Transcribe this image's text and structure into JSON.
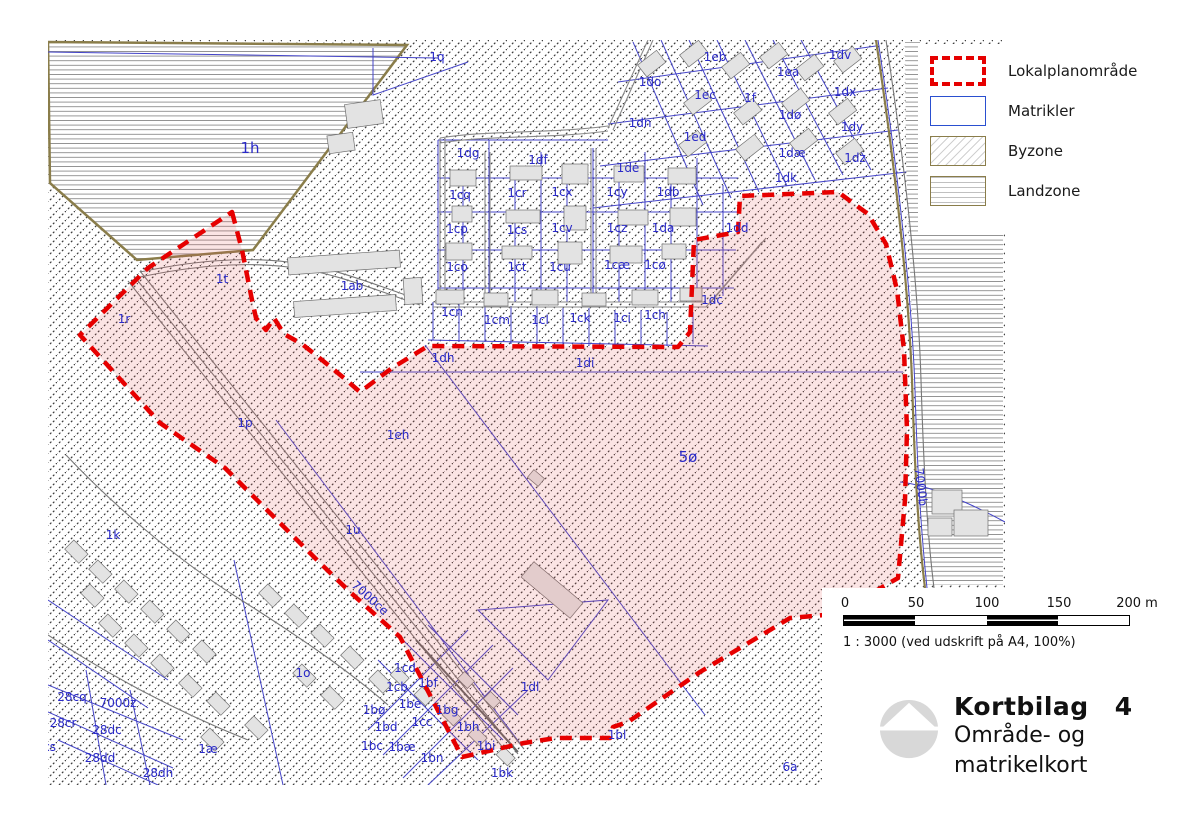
{
  "legend": {
    "items": [
      {
        "key": "lokalplan",
        "label": "Lokalplanområde"
      },
      {
        "key": "matrikler",
        "label": "Matrikler"
      },
      {
        "key": "byzone",
        "label": "Byzone"
      },
      {
        "key": "landzone",
        "label": "Landzone"
      }
    ]
  },
  "scalebar": {
    "ticks": [
      "0",
      "50",
      "100",
      "150",
      "200 m"
    ],
    "caption": "1 : 3000 (ved udskrift på A4, 100%)"
  },
  "title_block": {
    "title": "Kortbilag",
    "number": "4",
    "subtitle_line1": "Område- og",
    "subtitle_line2": "matrikelkort"
  },
  "colors": {
    "lokalplan_boundary": "#e60000",
    "lokalplan_fill": "rgba(228,90,90,0.16)",
    "parcel_line": "#4444c8",
    "label_text": "#2a2ac8",
    "road_olive": "#8a7d4a",
    "landzone_line": "#8f8f8f",
    "byzone_line": "#3c3c3c",
    "building_fill": "#e3e3e3"
  },
  "map": {
    "region_labels": [
      {
        "text": "1h",
        "x": 202,
        "y": 108,
        "size": 15
      },
      {
        "text": "1q",
        "x": 389,
        "y": 17
      },
      {
        "text": "1dg",
        "x": 420,
        "y": 113
      },
      {
        "text": "1df",
        "x": 490,
        "y": 120
      },
      {
        "text": "1de",
        "x": 580,
        "y": 128
      },
      {
        "text": "1cq",
        "x": 412,
        "y": 155
      },
      {
        "text": "1cr",
        "x": 469,
        "y": 153
      },
      {
        "text": "1cx",
        "x": 514,
        "y": 152
      },
      {
        "text": "1cy",
        "x": 569,
        "y": 152
      },
      {
        "text": "1db",
        "x": 620,
        "y": 152
      },
      {
        "text": "1cp",
        "x": 409,
        "y": 189
      },
      {
        "text": "1cs",
        "x": 469,
        "y": 190
      },
      {
        "text": "1cv",
        "x": 514,
        "y": 188
      },
      {
        "text": "1cz",
        "x": 569,
        "y": 188
      },
      {
        "text": "1da",
        "x": 615,
        "y": 188
      },
      {
        "text": "1co",
        "x": 409,
        "y": 227
      },
      {
        "text": "1ct",
        "x": 469,
        "y": 227
      },
      {
        "text": "1cu",
        "x": 512,
        "y": 227
      },
      {
        "text": "1cæ",
        "x": 569,
        "y": 225
      },
      {
        "text": "1cø",
        "x": 607,
        "y": 225
      },
      {
        "text": "1cn",
        "x": 404,
        "y": 272
      },
      {
        "text": "1cm",
        "x": 449,
        "y": 280
      },
      {
        "text": "1cl",
        "x": 492,
        "y": 280
      },
      {
        "text": "1ck",
        "x": 532,
        "y": 278
      },
      {
        "text": "1ci",
        "x": 574,
        "y": 278
      },
      {
        "text": "1ch",
        "x": 607,
        "y": 275
      },
      {
        "text": "1dd",
        "x": 689,
        "y": 188
      },
      {
        "text": "1dc",
        "x": 664,
        "y": 260
      },
      {
        "text": "1eb",
        "x": 667,
        "y": 17
      },
      {
        "text": "1dv",
        "x": 792,
        "y": 15
      },
      {
        "text": "1do",
        "x": 602,
        "y": 42
      },
      {
        "text": "1ea",
        "x": 740,
        "y": 32
      },
      {
        "text": "1ec",
        "x": 657,
        "y": 55
      },
      {
        "text": "1f",
        "x": 702,
        "y": 58
      },
      {
        "text": "1dx",
        "x": 797,
        "y": 52
      },
      {
        "text": "1dn",
        "x": 592,
        "y": 83
      },
      {
        "text": "1dø",
        "x": 742,
        "y": 75
      },
      {
        "text": "1dy",
        "x": 804,
        "y": 87
      },
      {
        "text": "1ed",
        "x": 647,
        "y": 97
      },
      {
        "text": "1dæ",
        "x": 744,
        "y": 113
      },
      {
        "text": "1dz",
        "x": 807,
        "y": 118
      },
      {
        "text": "1dk",
        "x": 738,
        "y": 138
      },
      {
        "text": "1ab",
        "x": 304,
        "y": 246
      },
      {
        "text": "1t",
        "x": 174,
        "y": 239
      },
      {
        "text": "1r",
        "x": 76,
        "y": 279
      },
      {
        "text": "1p",
        "x": 197,
        "y": 383
      },
      {
        "text": "1u",
        "x": 305,
        "y": 490
      },
      {
        "text": "1eh",
        "x": 350,
        "y": 395
      },
      {
        "text": "1dh",
        "x": 395,
        "y": 318
      },
      {
        "text": "1di",
        "x": 537,
        "y": 323
      },
      {
        "text": "5ø",
        "x": 640,
        "y": 417,
        "size": 15
      },
      {
        "text": "1dl",
        "x": 482,
        "y": 647
      },
      {
        "text": "1k",
        "x": 65,
        "y": 495
      },
      {
        "text": "1o",
        "x": 255,
        "y": 633
      },
      {
        "text": "1æ",
        "x": 160,
        "y": 709
      },
      {
        "text": "28cq",
        "x": 24,
        "y": 657
      },
      {
        "text": "7000z",
        "x": 70,
        "y": 663
      },
      {
        "text": "28cr",
        "x": 15,
        "y": 683
      },
      {
        "text": "28dc",
        "x": 59,
        "y": 690
      },
      {
        "text": "28cs",
        "x": -6,
        "y": 707
      },
      {
        "text": "28dd",
        "x": 52,
        "y": 718
      },
      {
        "text": "28dh",
        "x": 110,
        "y": 733
      },
      {
        "text": "6a",
        "x": 742,
        "y": 727
      },
      {
        "text": "1cd",
        "x": 357,
        "y": 628
      },
      {
        "text": "1cb",
        "x": 349,
        "y": 647
      },
      {
        "text": "1bf",
        "x": 380,
        "y": 643
      },
      {
        "text": "1be",
        "x": 362,
        "y": 664
      },
      {
        "text": "1bg",
        "x": 399,
        "y": 670
      },
      {
        "text": "1bø",
        "x": 326,
        "y": 670
      },
      {
        "text": "1cc",
        "x": 374,
        "y": 682
      },
      {
        "text": "1bh",
        "x": 420,
        "y": 687
      },
      {
        "text": "1bd",
        "x": 338,
        "y": 687
      },
      {
        "text": "1bc",
        "x": 324,
        "y": 706
      },
      {
        "text": "1bæ",
        "x": 354,
        "y": 707
      },
      {
        "text": "1bi",
        "x": 438,
        "y": 706
      },
      {
        "text": "1bn",
        "x": 384,
        "y": 718
      },
      {
        "text": "1bk",
        "x": 454,
        "y": 733
      },
      {
        "text": "1bl",
        "x": 569,
        "y": 695
      },
      {
        "text": "7000ce",
        "x": 322,
        "y": 558,
        "rot": 42
      },
      {
        "text": "7000b",
        "x": 873,
        "y": 447,
        "rot": 83
      }
    ]
  }
}
